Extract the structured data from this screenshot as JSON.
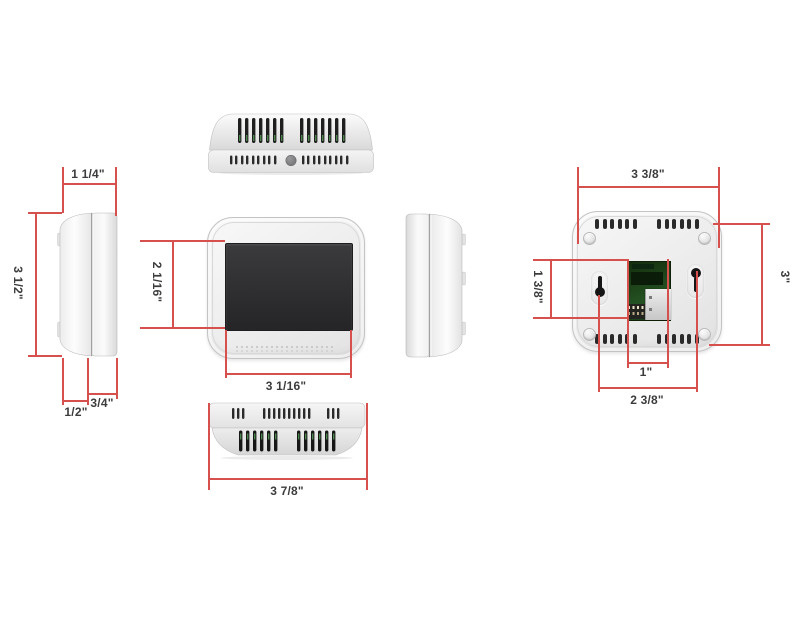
{
  "diagram": {
    "type": "product-dimension-diagram",
    "subject": "thermostat six-view drawing",
    "colors": {
      "background": "#ffffff",
      "dimension_line": "#d6514d",
      "label_text": "#3c3c3c",
      "device_body": "#ececec",
      "screen": "#2e2e30",
      "pcb_green": "#1d3a1e"
    }
  },
  "dimensions": {
    "side_left": {
      "depth_total": "1 1/4\"",
      "height": "3 1/2\"",
      "front_depth": "1/2\"",
      "back_depth": "3/4\""
    },
    "front": {
      "screen_height": "2 1/16\"",
      "screen_width": "3 1/16\""
    },
    "bottom": {
      "width": "3 7/8\""
    },
    "back": {
      "width": "3 3/8\"",
      "height": "3\"",
      "opening_height": "1 3/8\"",
      "opening_width": "1\"",
      "keyhole_spacing": "2 3/8\""
    }
  }
}
